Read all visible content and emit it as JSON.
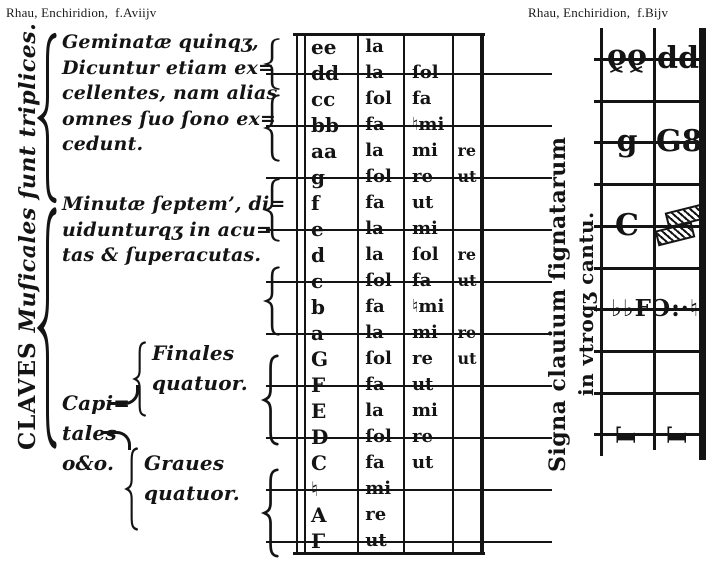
{
  "page": {
    "background": "#ffffff",
    "ink": "#141414"
  },
  "headers": {
    "left": "Rhau, Enchiridion,  f.Aviijv",
    "right": "Rhau, Enchiridion,  f.Bijv"
  },
  "left_panel": {
    "vertical_label_caps": "CLAVES",
    "vertical_label_rest": "Muſicales ſunt triplices.",
    "geminatae_lines": [
      "Geminatæ quinqʒ,",
      "Dicuntur etiam ex=",
      "cellentes, nam alias",
      "omnes ſuo ſono ex=",
      "cedunt."
    ],
    "minutae_lines": [
      "Minutæ ſeptem’, di=",
      "uidunturqʒ in acu=",
      "tas & ſuperacutas."
    ],
    "capitales_lines": [
      "Capi=",
      "tales",
      "o&o."
    ],
    "finales_lines": [
      "Finales",
      "quatuor."
    ],
    "graues_lines": [
      "Graues",
      "quatuor."
    ]
  },
  "gamut_table": {
    "rows": [
      {
        "letter": "ee",
        "syllables": [
          "la",
          "",
          ""
        ],
        "on_line": false
      },
      {
        "letter": "dd",
        "syllables": [
          "la",
          "ſol",
          ""
        ],
        "on_line": true
      },
      {
        "letter": "cc",
        "syllables": [
          "ſol",
          "fa",
          ""
        ],
        "on_line": false
      },
      {
        "letter": "bb",
        "syllables": [
          "fa",
          "♮mi",
          ""
        ],
        "on_line": true
      },
      {
        "letter": "aa",
        "syllables": [
          "la",
          "mi",
          "re"
        ],
        "on_line": false
      },
      {
        "letter": "g",
        "syllables": [
          "ſol",
          "re",
          "ut"
        ],
        "on_line": true
      },
      {
        "letter": "f",
        "syllables": [
          "fa",
          "ut",
          ""
        ],
        "on_line": false
      },
      {
        "letter": "e",
        "syllables": [
          "la",
          "mi",
          ""
        ],
        "on_line": true
      },
      {
        "letter": "d",
        "syllables": [
          "la",
          "ſol",
          "re"
        ],
        "on_line": false
      },
      {
        "letter": "c",
        "syllables": [
          "ſol",
          "fa",
          "ut"
        ],
        "on_line": true
      },
      {
        "letter": "b",
        "syllables": [
          "fa",
          "♮mi",
          ""
        ],
        "on_line": false
      },
      {
        "letter": "a",
        "syllables": [
          "la",
          "mi",
          "re"
        ],
        "on_line": true
      },
      {
        "letter": "G",
        "syllables": [
          "ſol",
          "re",
          "ut"
        ],
        "on_line": false
      },
      {
        "letter": "F",
        "syllables": [
          "fa",
          "ut",
          ""
        ],
        "on_line": true
      },
      {
        "letter": "E",
        "syllables": [
          "la",
          "mi",
          ""
        ],
        "on_line": false
      },
      {
        "letter": "D",
        "syllables": [
          "ſol",
          "re",
          ""
        ],
        "on_line": true
      },
      {
        "letter": "C",
        "syllables": [
          "fa",
          "ut",
          ""
        ],
        "on_line": false
      },
      {
        "letter": "♮",
        "syllables": [
          "mi",
          "",
          ""
        ],
        "on_line": true
      },
      {
        "letter": "A",
        "syllables": [
          "re",
          "",
          ""
        ],
        "on_line": false
      },
      {
        "letter": "Γ",
        "syllables": [
          "ut",
          "",
          ""
        ],
        "on_line": true
      }
    ]
  },
  "right_panel": {
    "vertical_label_line1": "Signa clauium ſignatarum",
    "vertical_label_line2": "in vtroqʒ cantu.",
    "scala": {
      "staff_line_count": 10,
      "clef_rows": [
        {
          "name": "dd-clef-signs",
          "line": 1,
          "left": "ðð",
          "right": "dd"
        },
        {
          "name": "g-clef-signs",
          "line": 3,
          "left": "g",
          "right": "G8"
        },
        {
          "name": "c-clef-signs",
          "line": 5,
          "left": "C",
          "right_icon": "hatched-square-sign"
        },
        {
          "name": "f-clef-signs",
          "line": 7,
          "span": "♭♭FƆ:·♮"
        },
        {
          "name": "gamma-clef-signs",
          "line": 10,
          "left": "Γ",
          "right": "Γ"
        }
      ]
    }
  }
}
